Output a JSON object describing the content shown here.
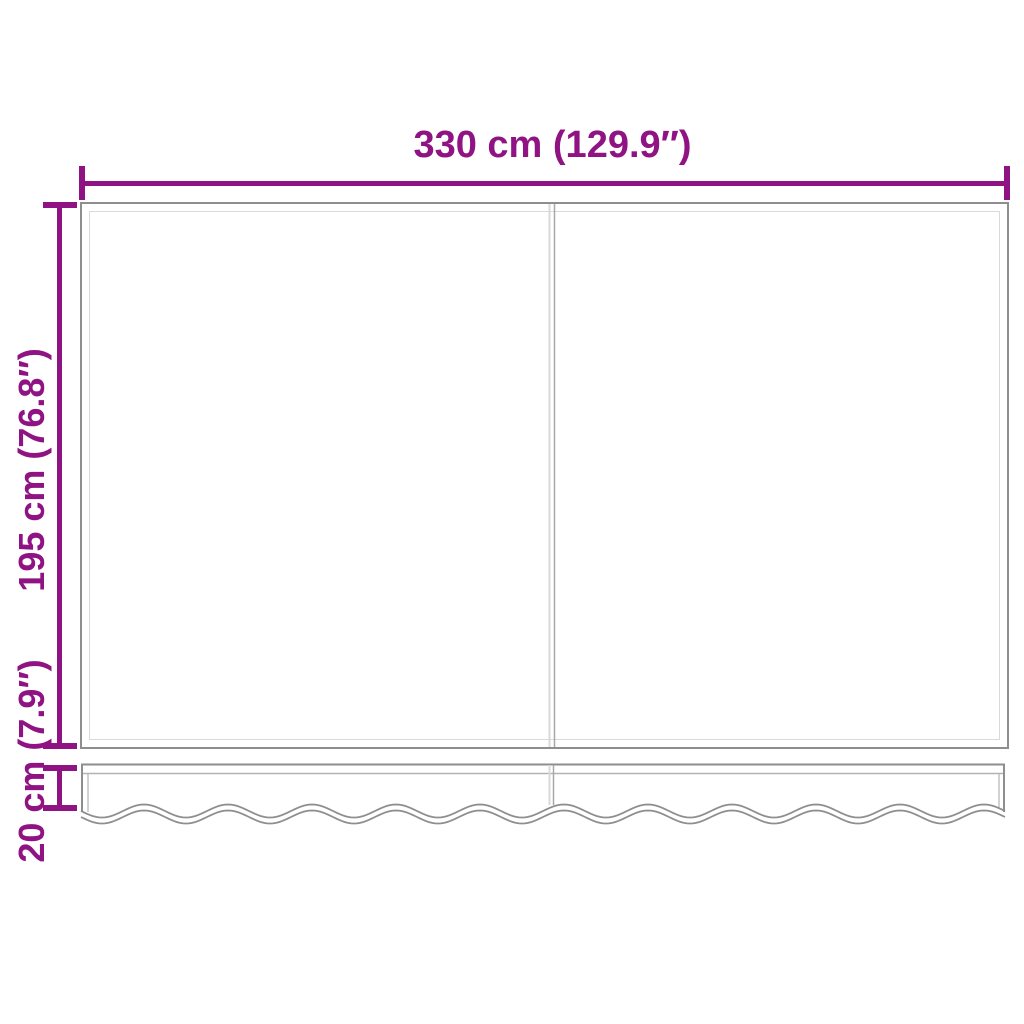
{
  "canvas": {
    "background": "#ffffff"
  },
  "diagram": {
    "accent_color": "#8F1382",
    "outline_color": "#8E8E8E",
    "soft_line_color": "#D9D9D9",
    "mid_line_color": "#B3B3B3",
    "panel_count": 2,
    "dimensions": {
      "width": {
        "label": "330 cm (129.9″)"
      },
      "height": {
        "label": "195 cm (76.8″)"
      },
      "valance_height": {
        "label": "20 cm (7.9″)"
      }
    }
  }
}
